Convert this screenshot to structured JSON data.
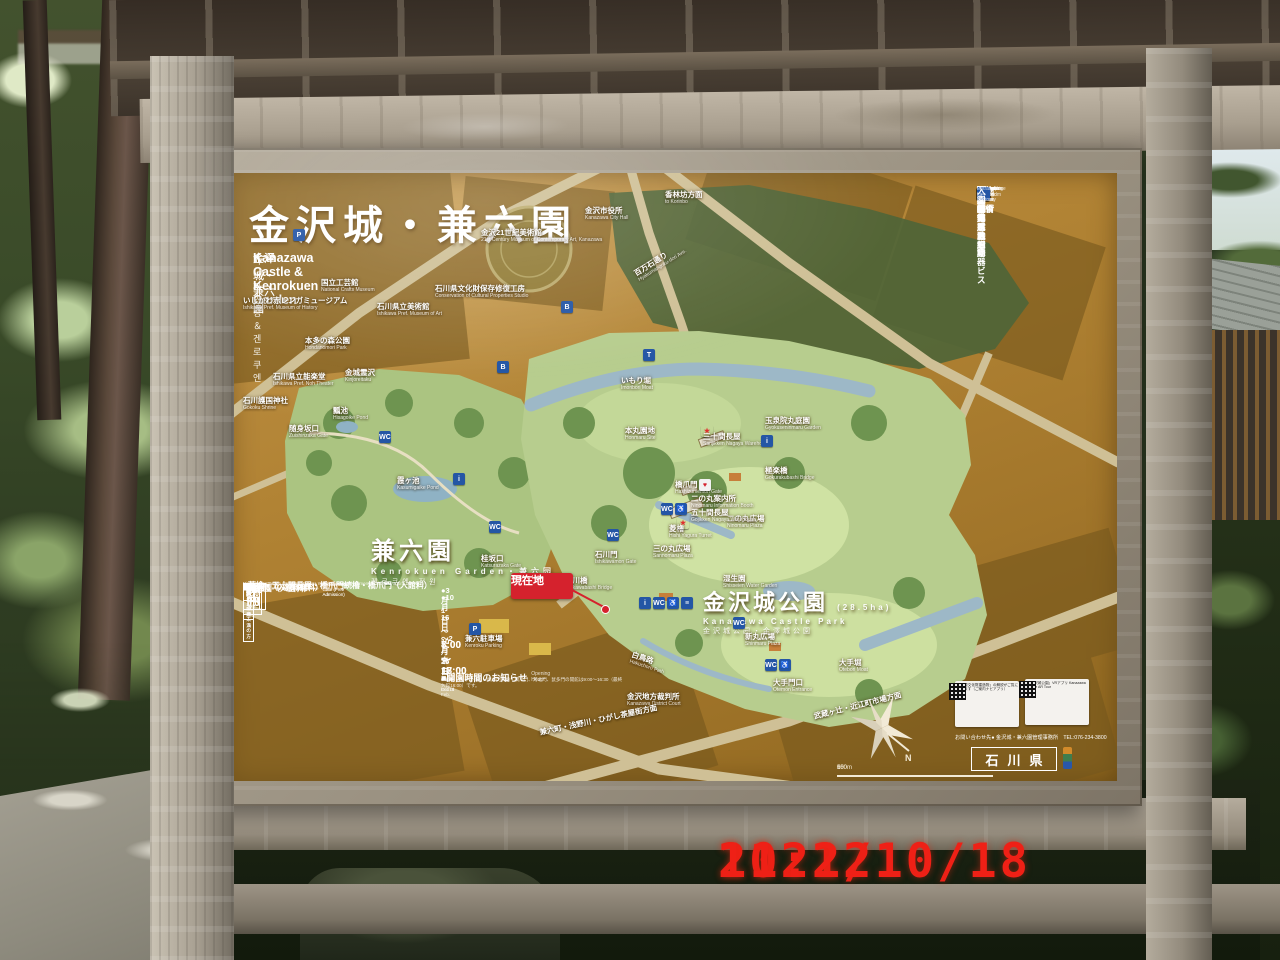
{
  "photo": {
    "datestamp": {
      "date": "2021/10/18",
      "time": "11:22",
      "color": "#ef2016"
    }
  },
  "board": {
    "title_ja": "金沢城・兼六園",
    "subtitle_en": "Kanazawa Castle & Kenrokuen Garden",
    "subtitle_ko": "가나자와 성＆겐로쿠엔",
    "subtitle_zh_simplified": "金泽城・兼六园",
    "subtitle_zh_traditional": "金澤城・兼六園",
    "accent_ochre": "#b08233",
    "legend_blue": "#2456a5",
    "marker_red": "#d5222d"
  },
  "legend": {
    "items": [
      {
        "icon": "information-icon",
        "glyph": "i",
        "bg": "#2456a5",
        "fg": "#fff",
        "ja": "案内所",
        "en": "Information Booth"
      },
      {
        "icon": "cafe-icon",
        "glyph": "C",
        "bg": "#2456a5",
        "fg": "#fff",
        "ja": "カフェ・軽食",
        "en": "Coffee stand"
      },
      {
        "icon": "toilet-icon",
        "glyph": "WC",
        "bg": "#2456a5",
        "fg": "#fff",
        "ja": "お手洗",
        "en": "Washroom"
      },
      {
        "icon": "accessible-toilet-icon",
        "glyph": "♿",
        "bg": "#2456a5",
        "fg": "#fff",
        "ja": "多目的お手洗",
        "en": "Multipurpose Washroom"
      },
      {
        "icon": "ostomate-icon",
        "glyph": "O",
        "bg": "#2456a5",
        "fg": "#fff",
        "ja": "オストメイト対応",
        "en": "Ostomate"
      },
      {
        "icon": "bus-icon",
        "glyph": "B",
        "bg": "#2456a5",
        "fg": "#fff",
        "ja": "バス",
        "en": "Bus"
      },
      {
        "icon": "sightseeing-bus-icon",
        "glyph": "B",
        "bg": "#7a3b6e",
        "fg": "#fff",
        "ja": "定期観光バス",
        "en": "Sightseeing Bus"
      },
      {
        "icon": "taxi-icon",
        "glyph": "T",
        "bg": "#2456a5",
        "fg": "#fff",
        "ja": "タクシー",
        "en": "Taxi"
      },
      {
        "icon": "parking-icon",
        "glyph": "P",
        "bg": "#2456a5",
        "fg": "#fff",
        "ja": "駐車場",
        "en": "Parking Area"
      },
      {
        "icon": "dropoff-parking-icon",
        "glyph": "P",
        "bg": "#2456a5",
        "fg": "#fff",
        "ja": "乗降者専用駐車場",
        "en": "Parking Area for Pick-up / Drop-off"
      },
      {
        "icon": "bicycle-parking-icon",
        "glyph": "B",
        "bg": "#2456a5",
        "fg": "#fff",
        "ja": "駐輪場",
        "en": "Bicycle Parking Area"
      },
      {
        "icon": "shrine-icon",
        "glyph": "⛩",
        "bg": "#2456a5",
        "fg": "#fff",
        "ja": "神社",
        "en": "Shrine"
      },
      {
        "icon": "police-box-icon",
        "glyph": "交",
        "bg": "#2456a5",
        "fg": "#fff",
        "ja": "交番",
        "en": "Police Box"
      },
      {
        "icon": "park-icon",
        "glyph": "木",
        "bg": "#2456a5",
        "fg": "#fff",
        "ja": "公園",
        "en": "Park"
      },
      {
        "icon": "museum-icon",
        "glyph": "血",
        "bg": "#2456a5",
        "fg": "#fff",
        "ja": "博物館・美術館",
        "en": "Museum"
      },
      {
        "icon": "coin-locker-icon",
        "glyph": "≡",
        "bg": "#2456a5",
        "fg": "#fff",
        "ja": "コインロッカー",
        "en": "Coin-operated Lockers"
      },
      {
        "icon": "aed-icon",
        "glyph": "♥",
        "bg": "#f2f2f2",
        "fg": "#d5222d",
        "ja": "自動体外式除細動器",
        "en": "AED"
      },
      {
        "icon": "wheelchair-rental-icon",
        "glyph": "♿",
        "bg": "#2456a5",
        "fg": "#fff",
        "ja": "車椅子貸し出しサービス",
        "en": "Wheelchair Rental Service"
      },
      {
        "icon": "cultural-property-icon",
        "glyph": "★",
        "bg": "transparent",
        "fg": "#e03030",
        "ja": "重要文化財",
        "en": "Important Cultural Property"
      },
      {
        "icon": "entrance-icon",
        "glyph": "→",
        "bg": "#2456a5",
        "fg": "#fff",
        "ja": "入園者出入口",
        "en": "Entrance for Visitors"
      }
    ]
  },
  "map": {
    "big_labels": {
      "kenrokuen": {
        "ja": "兼六園",
        "en": "Kenrokuen Garden・兼六园",
        "ko": "켄로쿠엔 정원"
      },
      "castle_park": {
        "ja": "金沢城公園",
        "area": "(28.5ha)",
        "en": "Kanazawa Castle Park",
        "zh": "金沢城公园・金澤城公園"
      }
    },
    "you_are_here": {
      "ja": "現在地",
      "en": "You Are Here"
    },
    "labels": [
      {
        "x": 252,
        "y": 56,
        "ja": "金沢21世紀美術館",
        "en": "21st Century Museum of Contemporary Art, Kanazawa"
      },
      {
        "x": 356,
        "y": 34,
        "ja": "金沢市役所",
        "en": "Kanazawa City Hall"
      },
      {
        "x": 436,
        "y": 18,
        "ja": "香林坊方面",
        "en": "to Korinbo"
      },
      {
        "x": 404,
        "y": 98,
        "ja": "百万石通り",
        "en": "Hyakumangoku-dori Ave.",
        "rot": -32
      },
      {
        "x": 14,
        "y": 124,
        "ja": "いしかわ赤レンガミュージアム",
        "en": "Ishikawa Pref. Museum of History"
      },
      {
        "x": 92,
        "y": 106,
        "ja": "国立工芸館",
        "en": "National Crafts Museum"
      },
      {
        "x": 148,
        "y": 130,
        "ja": "石川県立美術館",
        "en": "Ishikawa Pref. Museum of Art"
      },
      {
        "x": 206,
        "y": 112,
        "ja": "石川県文化財保存修復工房",
        "en": "Conservation of Cultural Properties Studio"
      },
      {
        "x": 76,
        "y": 164,
        "ja": "本多の森公園",
        "en": "Hondanomori Park"
      },
      {
        "x": 44,
        "y": 200,
        "ja": "石川県立能楽堂",
        "en": "Ishikawa Pref. Noh Theater"
      },
      {
        "x": 14,
        "y": 224,
        "ja": "石川護国神社",
        "en": "Gokoku Shrine"
      },
      {
        "x": 116,
        "y": 196,
        "ja": "金城霊沢",
        "en": "Kinjoreitaku"
      },
      {
        "x": 104,
        "y": 234,
        "ja": "瓢池",
        "en": "Hisagoike Pond"
      },
      {
        "x": 60,
        "y": 252,
        "ja": "随身坂口",
        "en": "Zuishinzaka Gate"
      },
      {
        "x": 168,
        "y": 304,
        "ja": "霞ヶ池",
        "en": "Kasumigaike Pond"
      },
      {
        "x": 252,
        "y": 382,
        "ja": "桂坂口",
        "en": "Katsurazaka Gate"
      },
      {
        "x": 336,
        "y": 404,
        "ja": "石川橋",
        "en": "Ishikawabashi Bridge"
      },
      {
        "x": 366,
        "y": 378,
        "ja": "石川門",
        "en": "Ishikawamon Gate"
      },
      {
        "x": 424,
        "y": 372,
        "ja": "三の丸広場",
        "en": "Sannomaru Plaza"
      },
      {
        "x": 498,
        "y": 342,
        "ja": "二の丸広場",
        "en": "Ninomaru Plaza"
      },
      {
        "x": 462,
        "y": 322,
        "ja": "二の丸案内所",
        "en": "Ninomaru Information Booth"
      },
      {
        "x": 440,
        "y": 352,
        "ja": "菱櫓",
        "en": "Hishi Yagura Turret"
      },
      {
        "x": 462,
        "y": 336,
        "ja": "五十間長屋",
        "en": "Gojikken Nagaya Warehouse"
      },
      {
        "x": 446,
        "y": 308,
        "ja": "橋爪門",
        "en": "Hashizumemon Gate"
      },
      {
        "x": 474,
        "y": 260,
        "ja": "三十間長屋",
        "en": "Sanjikken Nagaya Warehouse"
      },
      {
        "x": 536,
        "y": 294,
        "ja": "極楽橋",
        "en": "Gokurakubashi Bridge"
      },
      {
        "x": 396,
        "y": 254,
        "ja": "本丸園地",
        "en": "Honmaru Site"
      },
      {
        "x": 536,
        "y": 244,
        "ja": "玉泉院丸庭園",
        "en": "Gyokuseninmaru Garden"
      },
      {
        "x": 392,
        "y": 204,
        "ja": "いもり堀",
        "en": "Imoribori Moat"
      },
      {
        "x": 516,
        "y": 460,
        "ja": "新丸広場",
        "en": "Shinmaru Plaza"
      },
      {
        "x": 544,
        "y": 506,
        "ja": "大手門口",
        "en": "Otemon Entrance"
      },
      {
        "x": 610,
        "y": 486,
        "ja": "大手堀",
        "en": "Otebori Moat"
      },
      {
        "x": 404,
        "y": 478,
        "ja": "白鳥路",
        "en": "Hakuchoro Path",
        "rot": 18
      },
      {
        "x": 494,
        "y": 402,
        "ja": "湿生園",
        "en": "Shisseien Water Garden"
      },
      {
        "x": 398,
        "y": 520,
        "ja": "金沢地方裁判所",
        "en": "Kanazawa District Court"
      },
      {
        "x": 236,
        "y": 462,
        "ja": "兼六駐車場",
        "en": "Kenroku Parking"
      },
      {
        "x": 310,
        "y": 556,
        "ja": "兼六町・浅野川・ひがし茶屋街方面",
        "rot": -12
      },
      {
        "x": 584,
        "y": 540,
        "ja": "武蔵ヶ辻・近江町市場方面",
        "rot": -14
      }
    ],
    "chips": [
      {
        "x": 410,
        "y": 424,
        "glyph": "i",
        "color": "#2456a5"
      },
      {
        "x": 424,
        "y": 424,
        "glyph": "WC",
        "color": "#2456a5"
      },
      {
        "x": 438,
        "y": 424,
        "glyph": "♿",
        "color": "#2456a5"
      },
      {
        "x": 452,
        "y": 424,
        "glyph": "≡",
        "color": "#2456a5"
      },
      {
        "x": 378,
        "y": 356,
        "glyph": "WC",
        "color": "#2456a5"
      },
      {
        "x": 432,
        "y": 330,
        "glyph": "WC",
        "color": "#2456a5"
      },
      {
        "x": 446,
        "y": 330,
        "glyph": "♿",
        "color": "#2456a5"
      },
      {
        "x": 532,
        "y": 262,
        "glyph": "i",
        "color": "#2456a5"
      },
      {
        "x": 536,
        "y": 486,
        "glyph": "WC",
        "color": "#2456a5"
      },
      {
        "x": 550,
        "y": 486,
        "glyph": "♿",
        "color": "#2456a5"
      },
      {
        "x": 504,
        "y": 444,
        "glyph": "WC",
        "color": "#2456a5"
      },
      {
        "x": 150,
        "y": 258,
        "glyph": "WC",
        "color": "#2456a5"
      },
      {
        "x": 224,
        "y": 300,
        "glyph": "i",
        "color": "#2456a5"
      },
      {
        "x": 260,
        "y": 348,
        "glyph": "WC",
        "color": "#2456a5"
      },
      {
        "x": 240,
        "y": 450,
        "glyph": "P",
        "color": "#2456a5"
      },
      {
        "x": 64,
        "y": 56,
        "glyph": "P",
        "color": "#2456a5"
      },
      {
        "x": 268,
        "y": 188,
        "glyph": "B",
        "color": "#2456a5"
      },
      {
        "x": 332,
        "y": 128,
        "glyph": "B",
        "color": "#2456a5"
      },
      {
        "x": 414,
        "y": 176,
        "glyph": "T",
        "color": "#2456a5"
      },
      {
        "x": 470,
        "y": 306,
        "glyph": "♥",
        "color": "#f2f2f2",
        "fg": "#d5222d"
      },
      {
        "x": 472,
        "y": 252,
        "glyph": "★",
        "color": "transparent",
        "fg": "#e03030"
      },
      {
        "x": 448,
        "y": 344,
        "glyph": "★",
        "color": "transparent",
        "fg": "#e03030"
      }
    ],
    "compass_label": "N",
    "scale_ticks": [
      "0",
      "50",
      "100",
      "150m"
    ]
  },
  "fees": {
    "section1_title": "■菱櫓・五十間長屋・橋爪門続櫓・橋爪門（入館料）",
    "section1_subtitle": "Hishiyagura Turret, Gojikken Nagaya Warehouse, Hashizumemon Tsuzukiyagura Turret, Hashizumemon Gate : Admission Fee",
    "columns": {
      "category": "区分",
      "individual": "個人",
      "group": "団体（30名以上）",
      "remarks": "備考"
    },
    "rows1": [
      {
        "category": "大人",
        "individual": "320円",
        "group": "250円",
        "remarks": "18歳以上の方"
      },
      {
        "category": "小人",
        "individual": "100円",
        "group": "80円",
        "remarks": "6歳以上18歳未満の方"
      }
    ],
    "free1": "■河北門（入館料無料）",
    "free1_en": "Kahokumon Gate (Free Admission)",
    "free2": "■鼠多門（入館料無料）",
    "free2_en": "Nezumitamon Gate (Free Admission)",
    "section2_title": "■兼六園（入園料）",
    "section2_subtitle": "Kenrokuen Garden : Admission Fee",
    "rows2": [
      {
        "category": "大人",
        "individual": "320円",
        "group": "250円",
        "remarks": "18歳以上の方"
      },
      {
        "category": "小人",
        "individual": "100円",
        "group": "80円",
        "remarks": "6歳以上18歳未満の方"
      }
    ]
  },
  "hours": {
    "title": "■開園時間のお知らせ",
    "title_en": "Opening Hours",
    "rows": [
      {
        "period": "●3月1日～10月15日",
        "period_en": "Mar.1 — Oct.15",
        "time": "7:00～18:00"
      },
      {
        "period": "●10月16日～2月末日",
        "period_en": "Oct.16 — End of Feb.",
        "time": "8:00～17:00"
      }
    ],
    "note": "※菱櫓・五十間長屋・橋爪門続櫓・橋爪門、河北門、鼠多門の開館は9:00～16:30（最終入館16:00）です。"
  },
  "footer": {
    "qr_left_title": "「重要文化財建造物」の解説がご覧になれます（ご案内ナビアプリ）",
    "qr_right_title": "「金沢城公園」VRアプリ",
    "qr_right_subtitle": "Kanazawa Castle AR Tour",
    "contact": "お問い合わせ先● 金沢城・兼六園管理事務所　TEL:076-234-3800",
    "prefecture": "石川県"
  }
}
